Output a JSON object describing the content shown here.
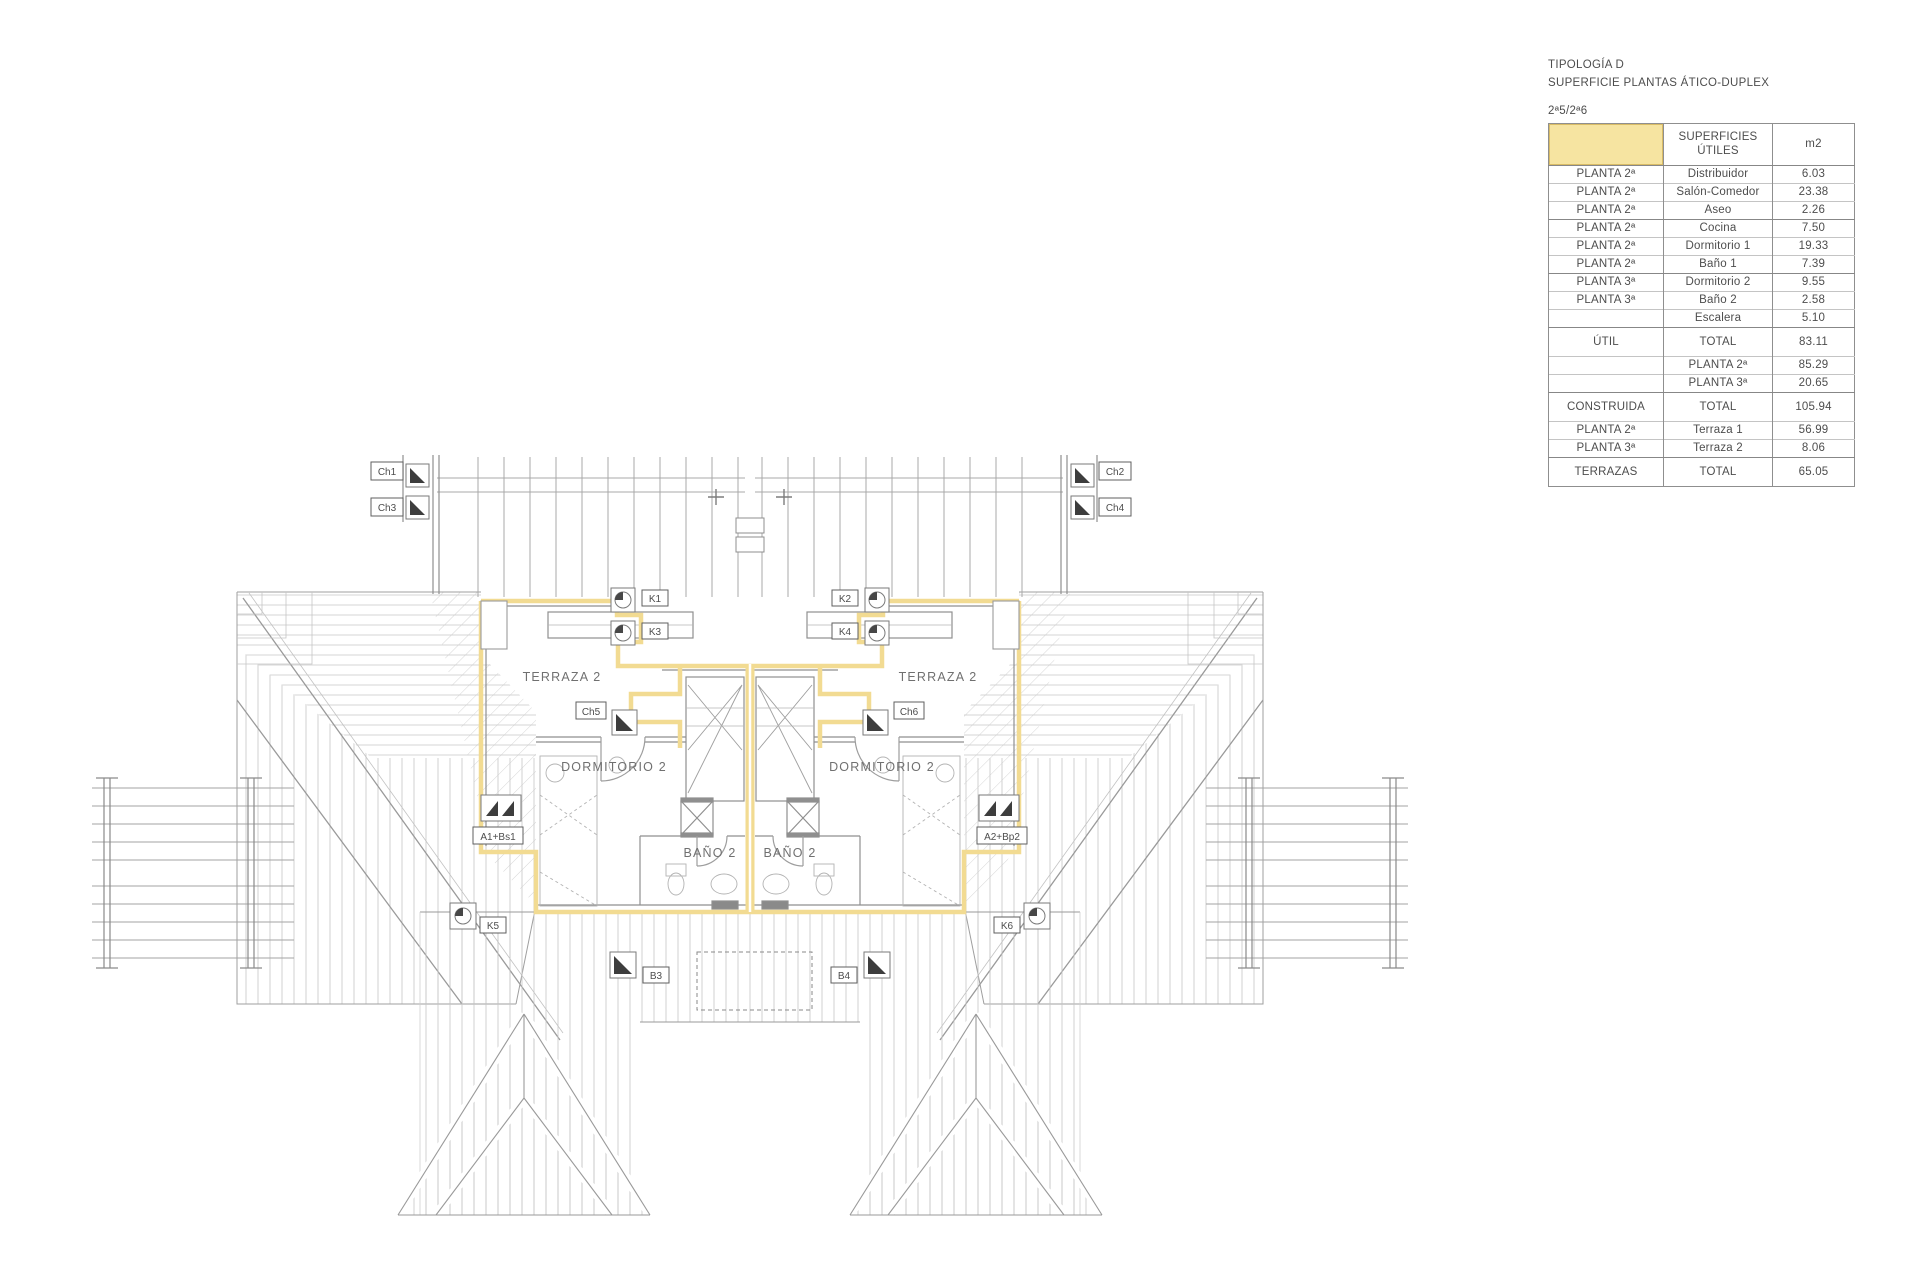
{
  "title_block": {
    "line1": "TIPOLOGÍA D",
    "line2": "SUPERFICIE PLANTAS ÁTICO-DUPLEX",
    "line3": "2ª5/2ª6"
  },
  "table": {
    "header": {
      "col2_line1": "SUPERFICIES",
      "col2_line2": "ÚTILES",
      "col3": "m2"
    },
    "rows": [
      {
        "c1": "PLANTA 2ª",
        "c2": "Distribuidor",
        "c3": "6.03"
      },
      {
        "c1": "PLANTA 2ª",
        "c2": "Salón-Comedor",
        "c3": "23.38"
      },
      {
        "c1": "PLANTA 2ª",
        "c2": "Aseo",
        "c3": "2.26"
      },
      {
        "c1": "PLANTA 2ª",
        "c2": "Cocina",
        "c3": "7.50"
      },
      {
        "c1": "PLANTA 2ª",
        "c2": "Dormitorio 1",
        "c3": "19.33"
      },
      {
        "c1": "PLANTA 2ª",
        "c2": "Baño 1",
        "c3": "7.39"
      },
      {
        "c1": "PLANTA 3ª",
        "c2": "Dormitorio 2",
        "c3": "9.55"
      },
      {
        "c1": "PLANTA 3ª",
        "c2": "Baño 2",
        "c3": "2.58"
      },
      {
        "c1": "",
        "c2": "Escalera",
        "c3": "5.10"
      },
      {
        "c1": "ÚTIL",
        "c2": "TOTAL",
        "c3": "83.11"
      },
      {
        "c1": "",
        "c2": "PLANTA 2ª",
        "c3": "85.29"
      },
      {
        "c1": "",
        "c2": "PLANTA 3ª",
        "c3": "20.65"
      },
      {
        "c1": "CONSTRUIDA",
        "c2": "TOTAL",
        "c3": "105.94"
      },
      {
        "c1": "PLANTA 2ª",
        "c2": "Terraza 1",
        "c3": "56.99"
      },
      {
        "c1": "PLANTA 3ª",
        "c2": "Terraza 2",
        "c3": "8.06"
      },
      {
        "c1": "TERRAZAS",
        "c2": "TOTAL",
        "c3": "65.05"
      }
    ]
  },
  "plan": {
    "rooms": {
      "terraza_left": "TERRAZA 2",
      "terraza_right": "TERRAZA 2",
      "dormitorio_left": "DORMITORIO 2",
      "dormitorio_right": "DORMITORIO 2",
      "bano_left": "BAÑO 2",
      "bano_right": "BAÑO 2"
    },
    "tags": {
      "ch1": "Ch1",
      "ch2": "Ch2",
      "ch3": "Ch3",
      "ch4": "Ch4",
      "ch5": "Ch5",
      "ch6": "Ch6",
      "k1": "K1",
      "k2": "K2",
      "k3": "K3",
      "k4": "K4",
      "k5": "K5",
      "k6": "K6",
      "b3": "B3",
      "b4": "B4",
      "a1": "A1+Bs1",
      "a2": "A2+Bp2"
    },
    "colors": {
      "highlight": "#F2DB92"
    }
  }
}
